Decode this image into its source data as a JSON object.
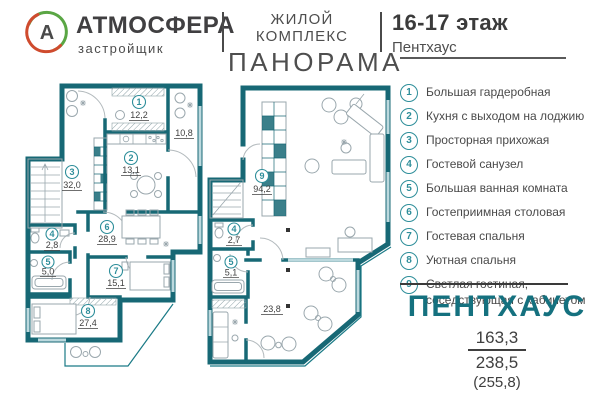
{
  "header": {
    "logo_letter": "А",
    "brand": "АТМОСФЕРА",
    "brand_subtitle": "застройщик",
    "complex_label": "ЖИЛОЙ КОМПЛЕКС",
    "complex_name": "ПАНОРАМА",
    "floor": "16-17 этаж",
    "floor_subtitle": "Пентхаус"
  },
  "legend": {
    "items": [
      {
        "num": "1",
        "label": "Большая гардеробная"
      },
      {
        "num": "2",
        "label": "Кухня с выходом на лоджию"
      },
      {
        "num": "3",
        "label": "Просторная прихожая"
      },
      {
        "num": "4",
        "label": "Гостевой санузел"
      },
      {
        "num": "5",
        "label": "Большая ванная комната"
      },
      {
        "num": "6",
        "label": "Гостеприимная столовая"
      },
      {
        "num": "7",
        "label": "Гостевая спальня"
      },
      {
        "num": "8",
        "label": "Уютная спальня"
      },
      {
        "num": "9",
        "label": "Светлая гостиная, соседствующая с кабинетом"
      }
    ]
  },
  "plans": {
    "floor16": {
      "rooms": [
        {
          "num": "1",
          "area": "12,2"
        },
        {
          "num": "2",
          "area": "13,1"
        },
        {
          "num": "3",
          "area": "32,0"
        },
        {
          "num": "4",
          "area": "2,8"
        },
        {
          "num": "5",
          "area": "5,0"
        },
        {
          "num": "6",
          "area": "28,9"
        },
        {
          "num": "7",
          "area": "15,1"
        },
        {
          "num": "8",
          "area": "27,4"
        }
      ],
      "loggia_area": "10,8"
    },
    "floor17": {
      "rooms": [
        {
          "num": "9",
          "area": "94,2"
        },
        {
          "num": "4",
          "area": "2,7"
        },
        {
          "num": "5",
          "area": "5,1"
        }
      ],
      "terrace_area": "23,8"
    }
  },
  "summary": {
    "title": "ПЕНТХАУС",
    "area_living": "163,3",
    "area_total": "238,5",
    "area_full": "(255,8)"
  },
  "colors": {
    "wall": "#176875",
    "accent": "#2e8e9a",
    "title": "#15717f"
  }
}
